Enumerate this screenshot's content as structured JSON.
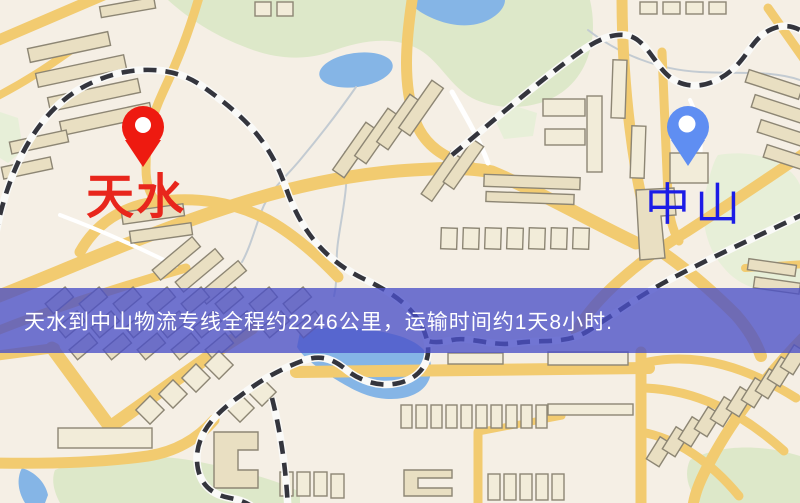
{
  "banner": {
    "text": "天水到中山物流专线全程约2246公里，运输时间约1天8小时.",
    "background": "rgba(74,80,200,0.78)",
    "text_color": "#ffffff"
  },
  "markers": {
    "origin": {
      "name": "天水",
      "pin_color": "#ee1a10",
      "label_color": "#e8261c"
    },
    "destination": {
      "name": "中山",
      "pin_color": "#5f8ef2",
      "label_color": "#1c1ce6"
    }
  },
  "map_colors": {
    "background": "#f5efe5",
    "park": "#dde8c9",
    "park_light": "#e7efd8",
    "water": "#85b5e6",
    "road": "#f2cb70",
    "building": "#e9dfc2",
    "building_light": "#f2ecd9",
    "building_outline": "#8d8674",
    "railway": "#34353d",
    "railway_casing": "#fafaf8",
    "stream": "#c3cbd2"
  }
}
